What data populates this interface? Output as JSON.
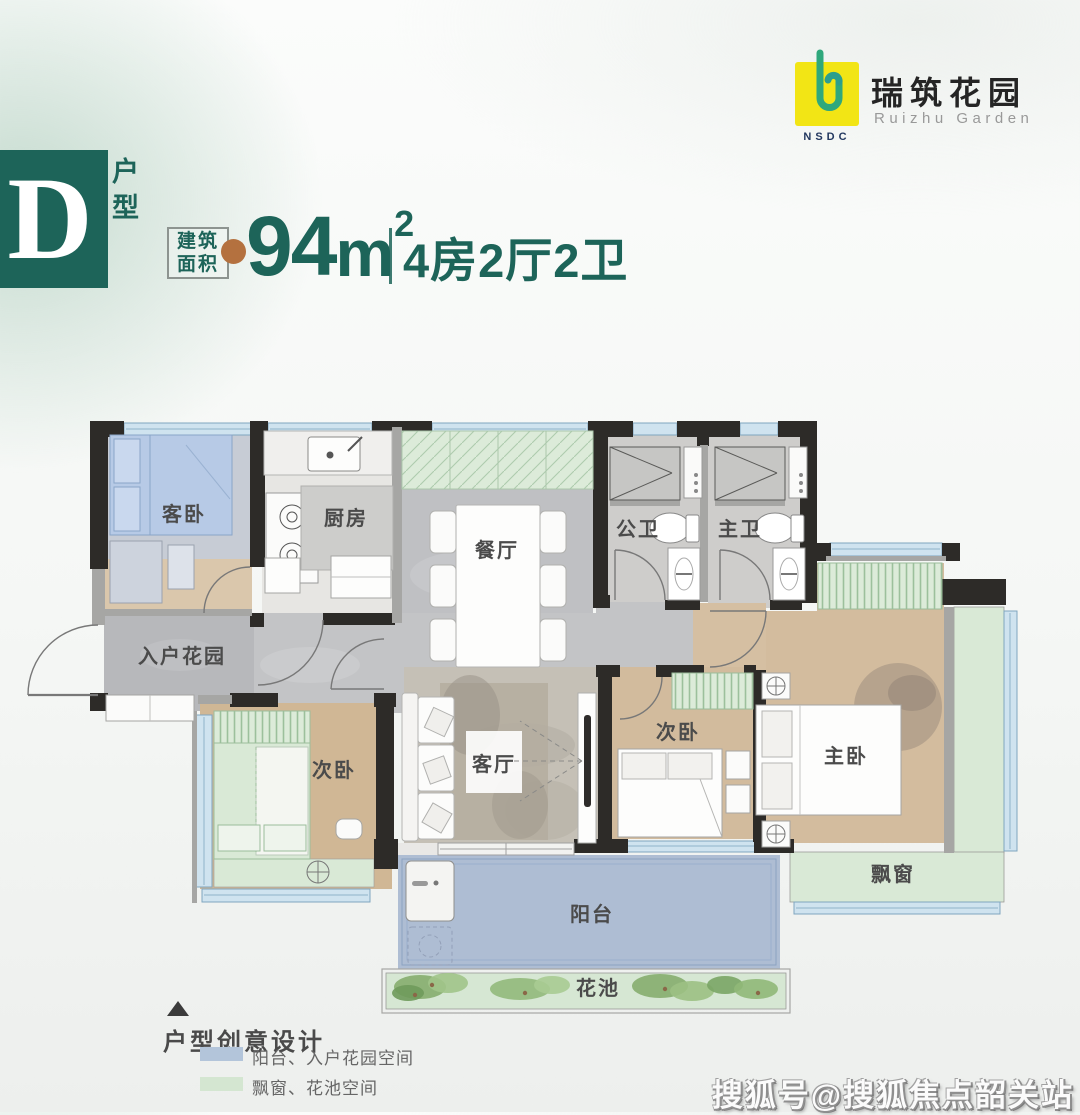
{
  "brand": {
    "nsdc": "NSDC",
    "name_cn": "瑞筑花园",
    "name_en": "Ruizhu Garden",
    "colors": {
      "logo_yellow": "#f2e515",
      "logo_green": "#2fa87c",
      "logo_navy": "#22375f"
    }
  },
  "unit": {
    "letter": "D",
    "type_label": "户型",
    "area_tag_line1": "建筑",
    "area_tag_line2": "面积",
    "area_value": "94",
    "area_unit": "m",
    "area_exponent": "2",
    "rooms_desc": "4房2厅2卫",
    "accent_color": "#1d6459",
    "dot_color": "#b4713f"
  },
  "floorplan": {
    "rooms": [
      {
        "id": "guest-bedroom",
        "label": "客卧"
      },
      {
        "id": "kitchen",
        "label": "厨房"
      },
      {
        "id": "dining-room",
        "label": "餐厅"
      },
      {
        "id": "public-bathroom",
        "label": "公卫"
      },
      {
        "id": "master-bathroom",
        "label": "主卫"
      },
      {
        "id": "entry-garden",
        "label": "入户花园"
      },
      {
        "id": "second-bedroom-left",
        "label": "次卧"
      },
      {
        "id": "living-room",
        "label": "客厅"
      },
      {
        "id": "second-bedroom-right",
        "label": "次卧"
      },
      {
        "id": "master-bedroom",
        "label": "主卧"
      },
      {
        "id": "bay-window",
        "label": "飘窗"
      },
      {
        "id": "balcony",
        "label": "阳台"
      },
      {
        "id": "flower-bed",
        "label": "花池"
      }
    ],
    "palette": {
      "wall": "#2d2b28",
      "wall_light": "#a6a6a4",
      "window": "#cfe3ef",
      "marble": "#bfc0c3",
      "wood": "#d2bb9d",
      "green_space": "#d9e9d6",
      "balcony_blue": "#aebdd3"
    }
  },
  "legend": {
    "marker": "▲",
    "title": "户型创意设计",
    "items": [
      {
        "label": "阳台、入户花园空间",
        "color": "#b3c5da"
      },
      {
        "label": "飘窗、花池空间",
        "color": "#d4e6d1"
      }
    ]
  },
  "watermark": {
    "text": "搜狐号@搜狐焦点韶关站"
  }
}
